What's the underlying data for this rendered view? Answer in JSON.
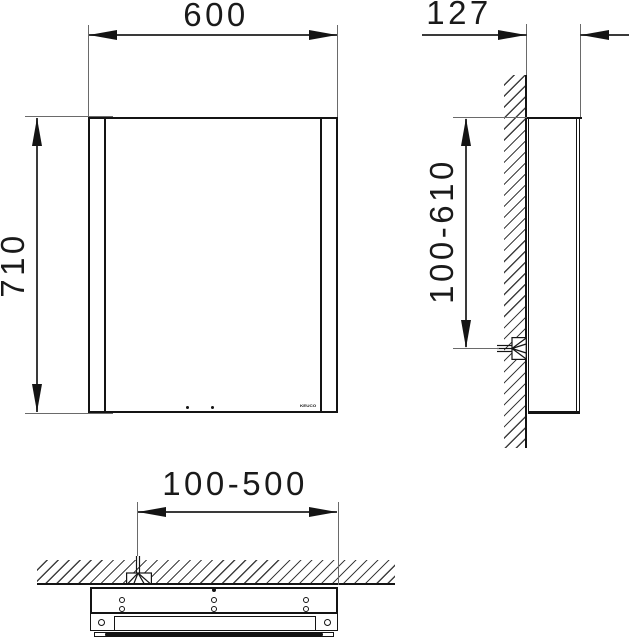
{
  "drawing": {
    "type": "mirror-cabinet-installation-drawing",
    "labels": {
      "front_width": "600",
      "side_depth": "127",
      "front_height": "710",
      "side_mount_range": "100-610",
      "bottom_mount_range": "100-500"
    },
    "logo_text": "KEUCO",
    "colors": {
      "line": "#141414",
      "dimension_line": "#3a3a3a",
      "background": "#ffffff"
    }
  }
}
